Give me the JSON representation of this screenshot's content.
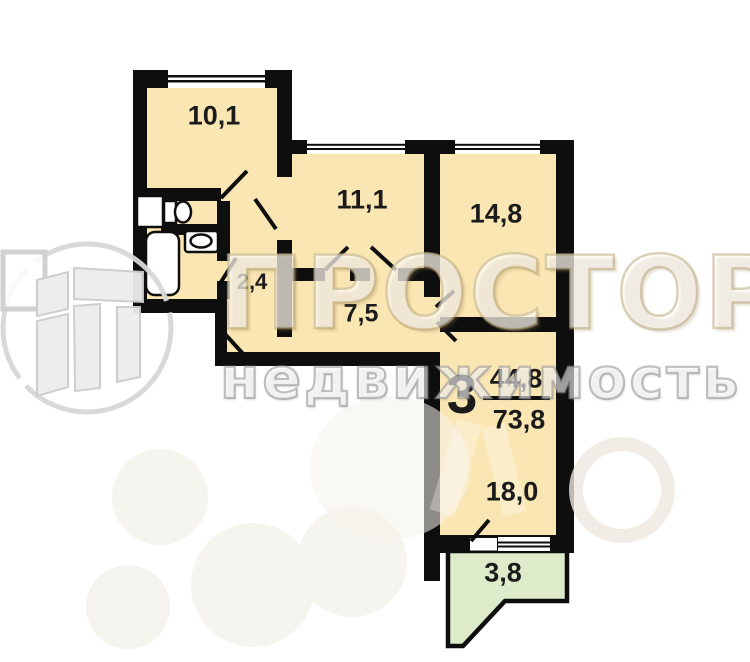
{
  "plan": {
    "apartment": {
      "rooms_count": "3",
      "living_area": "44,8",
      "total_area": "73,8"
    },
    "rooms": [
      {
        "name": "kitchen",
        "area": "10,1"
      },
      {
        "name": "room-1",
        "area": "11,1"
      },
      {
        "name": "room-2",
        "area": "14,8"
      },
      {
        "name": "hall",
        "area": "2,4"
      },
      {
        "name": "corridor",
        "area": "7,5"
      },
      {
        "name": "living-room",
        "area": "18,0"
      },
      {
        "name": "balcony",
        "area": "3,8"
      }
    ],
    "colors": {
      "room_fill": "#FAE6B2",
      "balcony_fill": "#DDEBCA",
      "wall": "#0E0E0E",
      "label_text": "#1B1B1B"
    }
  },
  "watermarks": {
    "agency_name": "ПРОСТОР",
    "agency_tagline": "недвижимость"
  }
}
